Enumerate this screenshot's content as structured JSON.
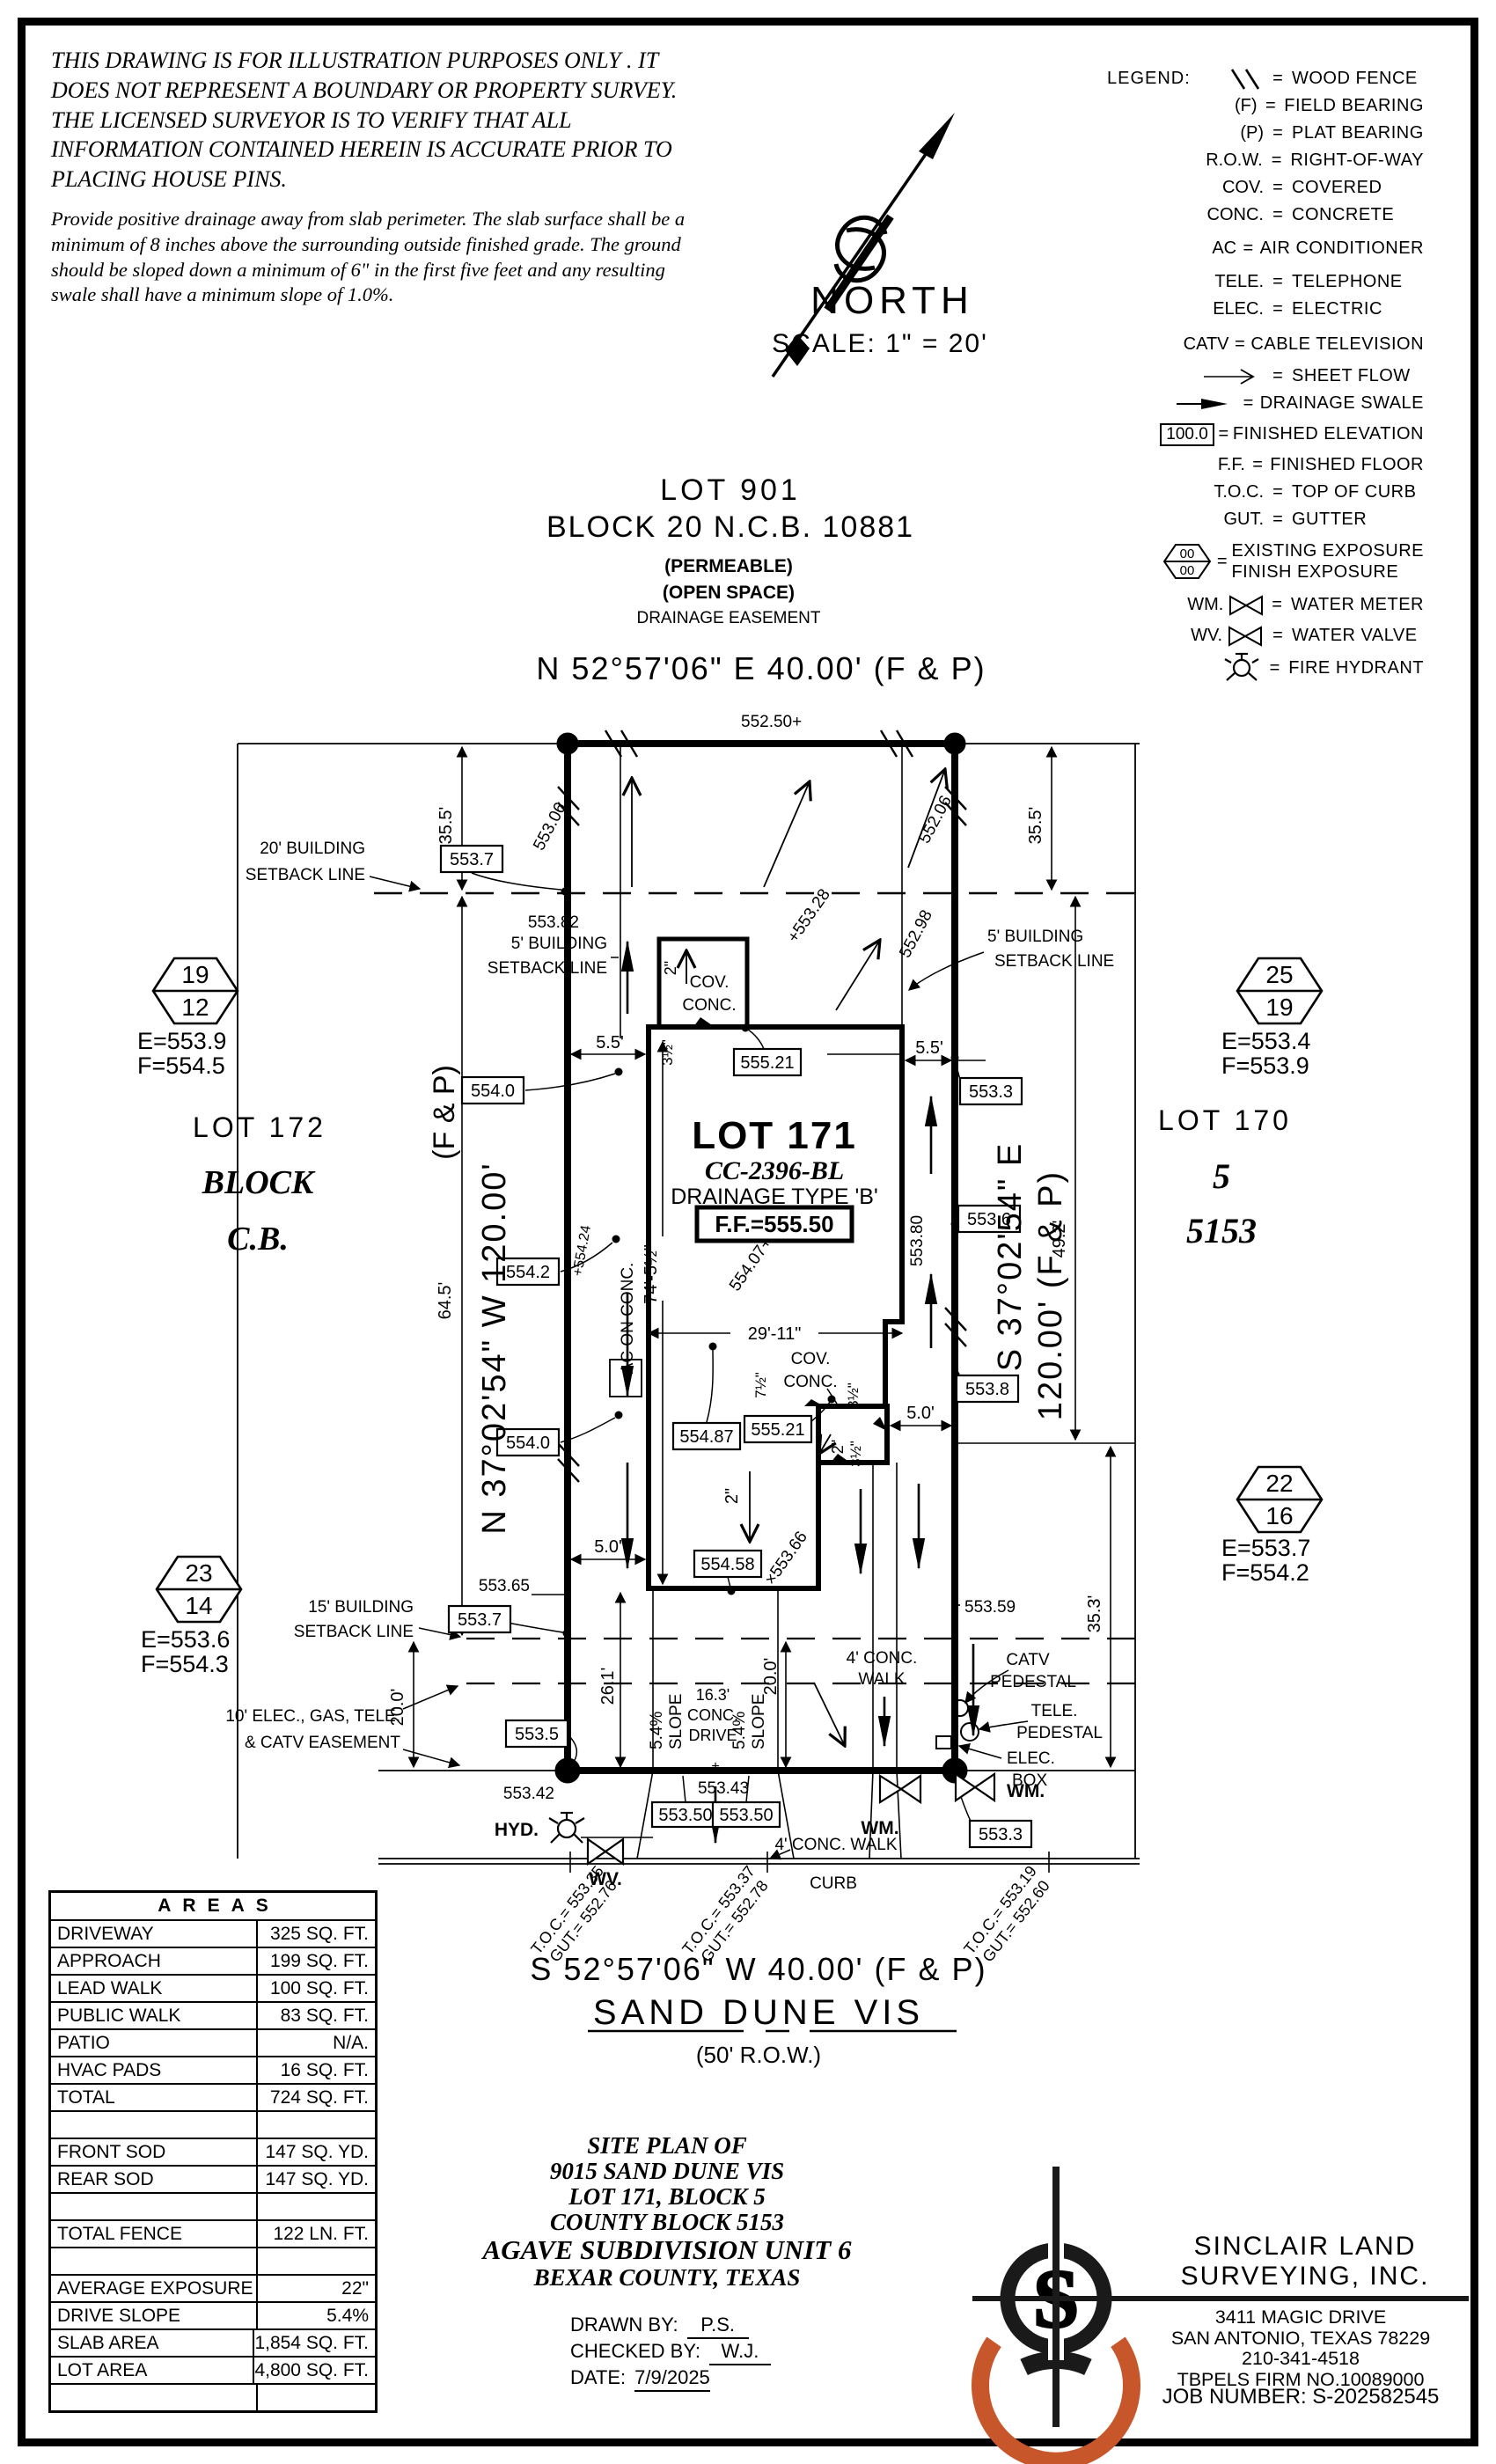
{
  "disclaimer": {
    "para1": "THIS DRAWING IS FOR ILLUSTRATION PURPOSES ONLY . IT DOES NOT REPRESENT A BOUNDARY OR PROPERTY SURVEY. THE LICENSED SURVEYOR IS TO VERIFY THAT ALL INFORMATION CONTAINED HEREIN IS ACCURATE PRIOR TO PLACING HOUSE PINS.",
    "para2": "Provide positive drainage away from slab perimeter. The slab surface shall be a minimum of 8 inches above the surrounding outside finished grade. The ground should be sloped down a minimum of 6\" in the first five feet and any resulting swale shall have a minimum slope of 1.0%."
  },
  "north": {
    "label": "NORTH",
    "scale": "SCALE:  1\" = 20'"
  },
  "legend": {
    "title": "LEGEND:",
    "equals": "=",
    "rows": [
      {
        "key": "",
        "desc": "WOOD FENCE"
      },
      {
        "key": "(F)",
        "desc": "FIELD BEARING"
      },
      {
        "key": "(P)",
        "desc": "PLAT BEARING"
      },
      {
        "key": "R.O.W.",
        "desc": "RIGHT-OF-WAY"
      },
      {
        "key": "COV.",
        "desc": "COVERED"
      },
      {
        "key": "CONC.",
        "desc": "CONCRETE"
      },
      {
        "key": "AC",
        "desc": "AIR CONDITIONER"
      },
      {
        "key": "TELE.",
        "desc": "TELEPHONE"
      },
      {
        "key": "ELEC.",
        "desc": "ELECTRIC"
      },
      {
        "key": "CATV",
        "desc": "CABLE TELEVISION"
      },
      {
        "key": "",
        "desc": "SHEET FLOW"
      },
      {
        "key": "",
        "desc": "DRAINAGE SWALE"
      },
      {
        "key": "100.0",
        "desc": "FINISHED ELEVATION"
      },
      {
        "key": "F.F.",
        "desc": "FINISHED FLOOR"
      },
      {
        "key": "T.O.C.",
        "desc": "TOP OF CURB"
      },
      {
        "key": "GUT.",
        "desc": "GUTTER"
      },
      {
        "key": "",
        "hex_top": "00",
        "hex_bot": "00",
        "desc": "EXISTING EXPOSURE",
        "desc2": "FINISH EXPOSURE"
      },
      {
        "key": "WM.",
        "desc": "WATER METER"
      },
      {
        "key": "WV.",
        "desc": "WATER VALVE"
      },
      {
        "key": "",
        "desc": "FIRE HYDRANT"
      }
    ]
  },
  "lot901": {
    "line1": "LOT 901",
    "line2": "BLOCK 20 N.C.B. 10881",
    "line3": "(PERMEABLE)",
    "line4": "(OPEN SPACE)",
    "line5": "DRAINAGE EASEMENT"
  },
  "plat": {
    "bearing_top": "N 52°57'06\" E 40.00' (F & P)",
    "bearing_bottom": "S 52°57'06\" W 40.00' (F & P)",
    "street": "SAND DUNE VIS",
    "row": "(50' R.O.W.)",
    "br_left_main": "N 37°02'54\" W 120.00'",
    "br_left_fp": "(F & P)",
    "br_right_1": "S 37°02'54\" E",
    "br_right_2": "120.00' (F & P)",
    "frontage_top": "552.50+",
    "elev_tl": "553.06",
    "elev_tr": "552.06",
    "dim_355_l": "35.5'",
    "dim_355_r": "35.5'",
    "dim_645": "64.5'",
    "dim_492": "49.2'",
    "dim_353": "35.3'",
    "dim_200_l": "20.0'",
    "dim_200_m": "20.0'",
    "dim_261": "26.1'",
    "dim_55_l": "5.5'",
    "dim_55_r": "5.5'",
    "dim_50_l": "5.0'",
    "dim_50_r": "5.0'",
    "dim_2911": "29'-11\"",
    "dim_745": "74'-5½\"",
    "dim2_a": "2\"",
    "dim2_b": "2\"",
    "dim2_c": "2\"",
    "dim35_a": "3½\"",
    "dim35_b": "3½\"",
    "dim35_c": "3½\"",
    "dim75": "7½\"",
    "sb20_1": "20' BUILDING",
    "sb20_2": "SETBACK LINE",
    "sb5l_1": "5' BUILDING",
    "sb5l_2": "SETBACK LINE",
    "sb5r_1": "5' BUILDING",
    "sb5r_2": "SETBACK LINE",
    "sb15_1": "15' BUILDING",
    "sb15_2": "SETBACK LINE",
    "ease_1": "10' ELEC., GAS, TELE.",
    "ease_2": "& CATV EASEMENT",
    "elev_55382": "553.82",
    "elev_55298": "552.98",
    "elev_55328": "+553.28",
    "hex1_top": "19",
    "hex1_bot": "12",
    "hex1_e": "E=553.9",
    "hex1_f": "F=554.5",
    "hex2_top": "25",
    "hex2_bot": "19",
    "hex2_e": "E=553.4",
    "hex2_f": "F=553.9",
    "hex3_top": "23",
    "hex3_bot": "14",
    "hex3_e": "E=553.6",
    "hex3_f": "F=554.3",
    "hex4_top": "22",
    "hex4_bot": "16",
    "hex4_e": "E=553.7",
    "hex4_f": "F=554.2",
    "lot172_1": "LOT 172",
    "lot172_2": "BLOCK",
    "lot172_3": "C.B.",
    "lot170_1": "LOT 170",
    "lot170_2": "5",
    "lot170_3": "5153",
    "lot171_1": "LOT 171",
    "lot171_2": "CC-2396-BL",
    "lot171_3": "DRAINAGE TYPE 'B'",
    "lot171_ff": "F.F.=555.50",
    "covt_1": "COV.",
    "covt_2": "CONC.",
    "covl_1": "COV.",
    "covl_2": "CONC.",
    "ac": "AC ON CONC.",
    "b_5537t": "553.7",
    "b_5540a": "554.0",
    "b_5542": "554.2",
    "b_5540b": "554.0",
    "b_55521t": "555.21",
    "b_5533tr": "553.3",
    "b_5536": "553.6",
    "b_5538": "553.8",
    "b_55487": "554.87",
    "b_55521l": "555.21",
    "b_55458": "554.58",
    "b_5537l": "553.7",
    "b_5535": "553.5",
    "b_5533br": "553.3",
    "b_55350a": "553.50",
    "b_55350b": "553.50",
    "elev_55380": "553.80",
    "elev_55424": "+554.24",
    "elev_55407": "554.07+",
    "elev_55366": "×553.66",
    "elev_55365": "553.65",
    "elev_55359": "553.59",
    "elev_55342": "553.42",
    "elev_55343": "553.43",
    "plus_mark": "+",
    "slope1_1": "5.4%",
    "slope1_2": "SLOPE",
    "slope2_1": "5.4%",
    "slope2_2": "SLOPE",
    "drive_1": "16.3'",
    "drive_2": "CONC.",
    "drive_3": "DRIVE",
    "walkr_1": "4' CONC.",
    "walkr_2": "WALK",
    "walk_street": "4' CONC. WALK",
    "curb": "CURB",
    "catv_1": "CATV",
    "catv_2": "PEDESTAL",
    "tele_1": "TELE.",
    "tele_2": "PEDESTAL",
    "eb_1": "ELEC.",
    "eb_2": "BOX",
    "wm_a": "WM.",
    "wm_b": "WM.",
    "wv": "WV.",
    "hyd": "HYD.",
    "toc1": "T.O.C.= 553.35",
    "gut1": "GUT.= 552.76",
    "toc2": "T.O.C.= 553.37",
    "gut2": "GUT.= 552.78",
    "toc3": "T.O.C.= 553.19",
    "gut3": "GUT.= 552.60"
  },
  "areas": {
    "header": "AREAS",
    "rows": [
      {
        "label": "DRIVEWAY",
        "value": "325 SQ. FT."
      },
      {
        "label": "APPROACH",
        "value": "199 SQ. FT."
      },
      {
        "label": "LEAD WALK",
        "value": "100 SQ. FT."
      },
      {
        "label": "PUBLIC WALK",
        "value": "83 SQ. FT."
      },
      {
        "label": "PATIO",
        "value": "N/A."
      },
      {
        "label": "HVAC PADS",
        "value": "16 SQ. FT."
      },
      {
        "label": "TOTAL",
        "value": "724 SQ. FT."
      },
      {
        "label": "",
        "value": ""
      },
      {
        "label": "FRONT SOD",
        "value": "147 SQ. YD."
      },
      {
        "label": "REAR SOD",
        "value": "147 SQ. YD."
      },
      {
        "label": "",
        "value": ""
      },
      {
        "label": "TOTAL FENCE",
        "value": "122 LN. FT."
      },
      {
        "label": "",
        "value": ""
      },
      {
        "label": "AVERAGE EXPOSURE",
        "value": "22\""
      },
      {
        "label": "DRIVE SLOPE",
        "value": "5.4%"
      },
      {
        "label": "SLAB AREA",
        "value": "1,854 SQ. FT."
      },
      {
        "label": "LOT AREA",
        "value": "4,800 SQ. FT."
      },
      {
        "label": "",
        "value": ""
      }
    ]
  },
  "title_block": {
    "l1": "SITE PLAN OF",
    "l2": "9015 SAND DUNE VIS",
    "l3": "LOT 171, BLOCK 5",
    "l4": "COUNTY BLOCK 5153",
    "l5": "AGAVE SUBDIVISION UNIT 6",
    "l6": "BEXAR COUNTY, TEXAS",
    "drawn_label": "DRAWN BY:",
    "drawn": "P.S.",
    "checked_label": "CHECKED BY:",
    "checked": "W.J.",
    "date_label": "DATE:",
    "date": "7/9/2025"
  },
  "firm": {
    "initial": "S",
    "name1": "SINCLAIR LAND",
    "name2": "SURVEYING, INC.",
    "addr1": "3411 MAGIC DRIVE",
    "addr2": "SAN ANTONIO, TEXAS 78229",
    "phone": "210-341-4518",
    "tbpels": "TBPELS FIRM NO.10089000",
    "job": "JOB NUMBER:  S-202582545"
  },
  "colors": {
    "accent_orange": "#C8562B",
    "ink": "#000000"
  }
}
